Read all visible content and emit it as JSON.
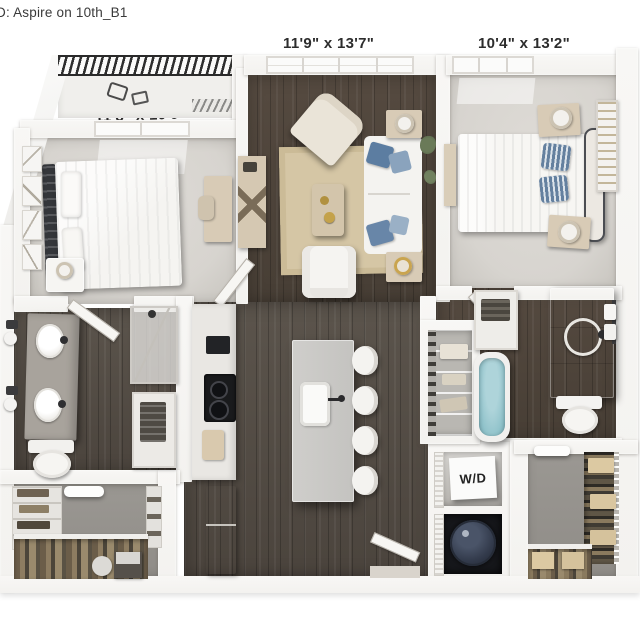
{
  "title": "D: Aspire on 10th_B1",
  "rooms": {
    "living_room": {
      "dims": "11'9\" x 13'7\""
    },
    "bedroom_right": {
      "dims": "10'4\" x 13'2\""
    },
    "bedroom_left": {
      "dims": "11'8\" x 10'0\""
    },
    "laundry": {
      "label": "W/D"
    }
  },
  "colors": {
    "wall": "#f3f2ef",
    "wood_dark": "#554a40",
    "wood_kitchen": "#5b544c",
    "carpet_bedroom": "#d7d4cf",
    "carpet_closet": "#8f8c87",
    "rug_tan": "#d5c6a5",
    "island_gray": "#c4c3c0",
    "vanity_gray": "#a8a39c",
    "water_teal": "#8fc2ca",
    "pillow_blue": "#64809f",
    "headboard_dark": "#34363a",
    "railing_dark": "#2e2e2e",
    "heater_navy": "#333b4c",
    "label_text": "#2d2d2d"
  }
}
